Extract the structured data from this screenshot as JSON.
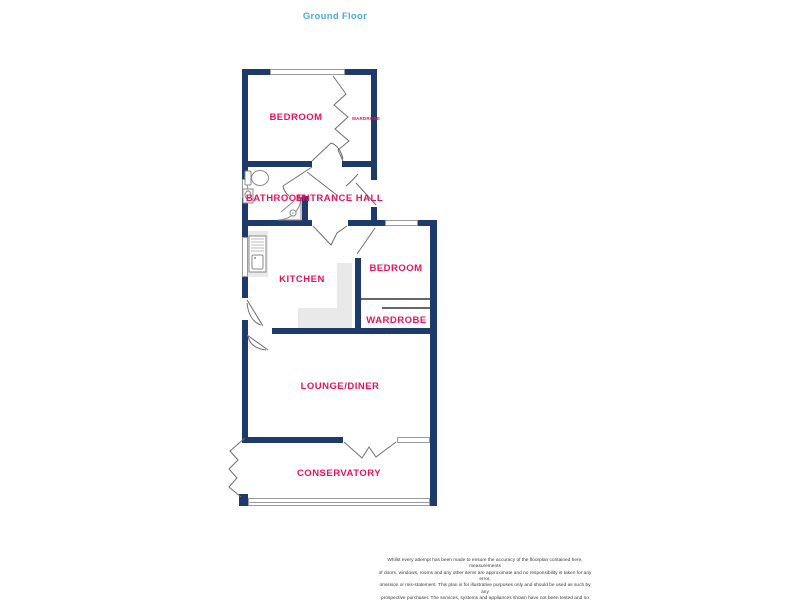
{
  "title": "Ground Floor",
  "colors": {
    "wall": "#1d3a6b",
    "room-label": "#eb115c",
    "title-color": "#4aabdf",
    "window-border": "#9a9a9a",
    "door-line": "#6f6f6f",
    "fixture-line": "#8a8a8a",
    "counter": "#e9e9e9",
    "divider": "#666666",
    "disclaimer": "#3a3a3a"
  },
  "rooms": {
    "bedroom1": "BEDROOM",
    "wardrobe1": "WARDROBE",
    "bathroom": "BATHROOM",
    "entrance_hall": "ENTRANCE HALL",
    "kitchen": "KITCHEN",
    "bedroom2": "BEDROOM",
    "wardrobe2": "WARDROBE",
    "lounge": "LOUNGE/DINER",
    "conservatory": "CONSERVATORY"
  },
  "disclaimer": {
    "lines": [
      "Whilst every attempt has been made to ensure the accuracy of the floorplan contained here, measurements",
      "of doors, windows, rooms and any other items are approximate and no responsibility is taken for any error,",
      "omission or mis-statement. This plan is for illustrative purposes only and should be used as such by any",
      "prospective purchaser. The services, systems and appliances shown have not been tested and no guarantee",
      "as to their operability or efficiency can be given.",
      "Made with Metropix ©2025"
    ]
  }
}
